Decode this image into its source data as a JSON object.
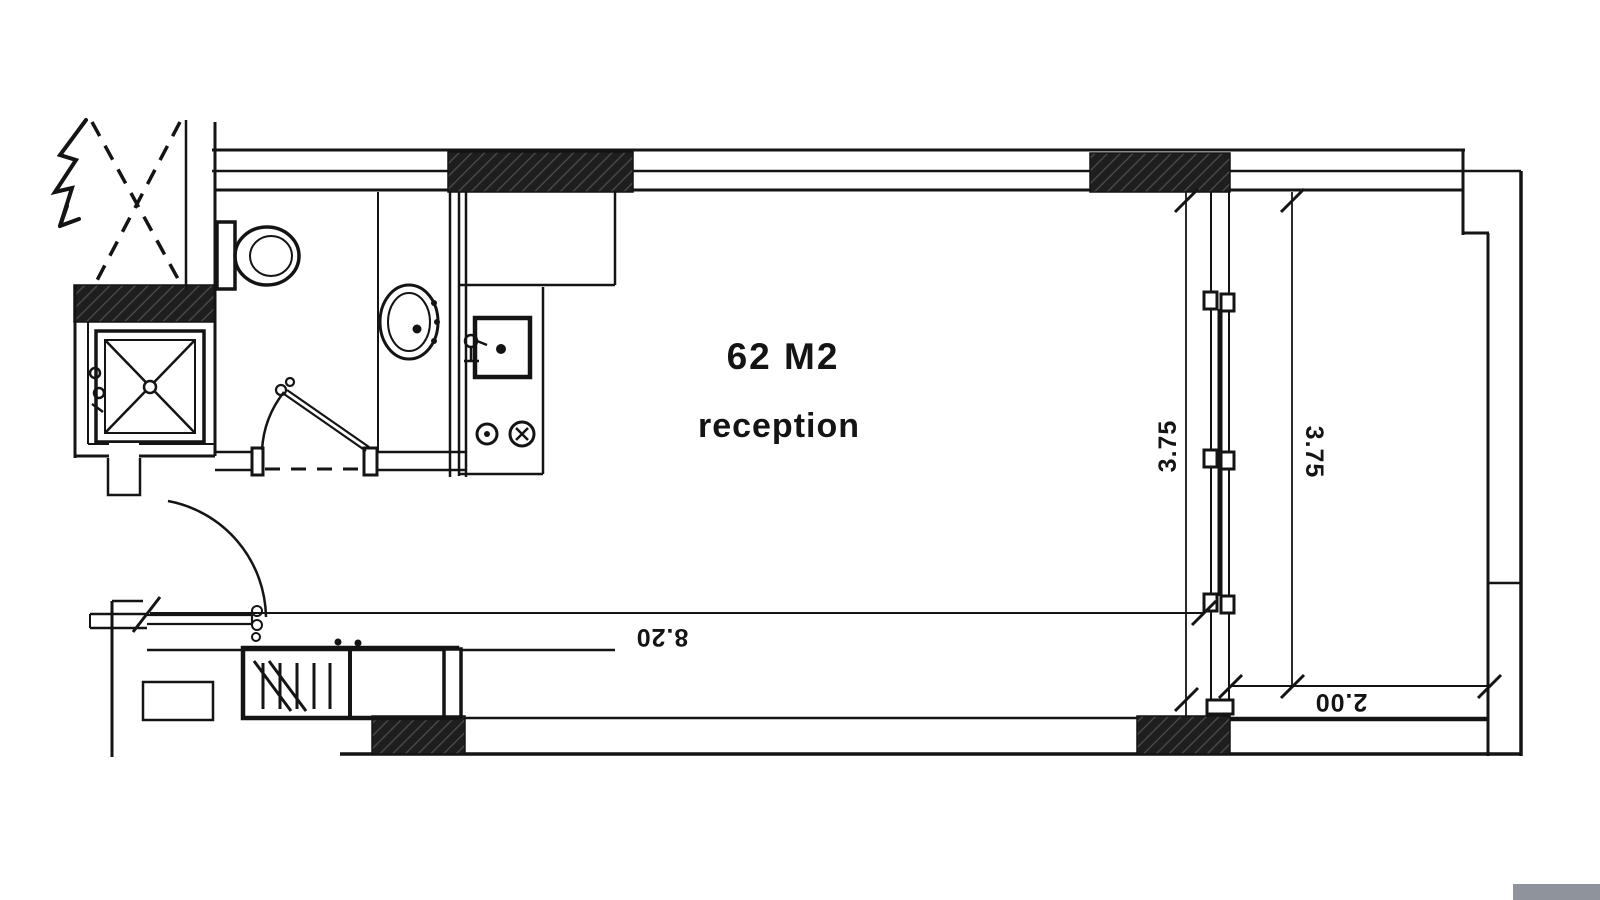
{
  "plan": {
    "area_label": "62 M2",
    "room_label": "reception",
    "colors": {
      "line": "#141414",
      "hatch_base": "#1e1e1e",
      "hatch_stripe": "#4d4d4d",
      "background": "#ffffff",
      "scrollbar": "#8f949c"
    }
  },
  "dimensions": {
    "room_width_m": "8.20",
    "room_depth_m": "3.75",
    "balcony_depth_m": "3.75",
    "balcony_width_m": "2.00"
  },
  "fixtures": [
    "entry-door",
    "entry-arrow",
    "void-shaft",
    "shower",
    "shower-mixer",
    "toilet",
    "bathroom-sink",
    "bathroom-door",
    "kitchen-counter",
    "kitchen-sink",
    "stove-burners",
    "wardrobe",
    "sliding-window",
    "balcony"
  ]
}
